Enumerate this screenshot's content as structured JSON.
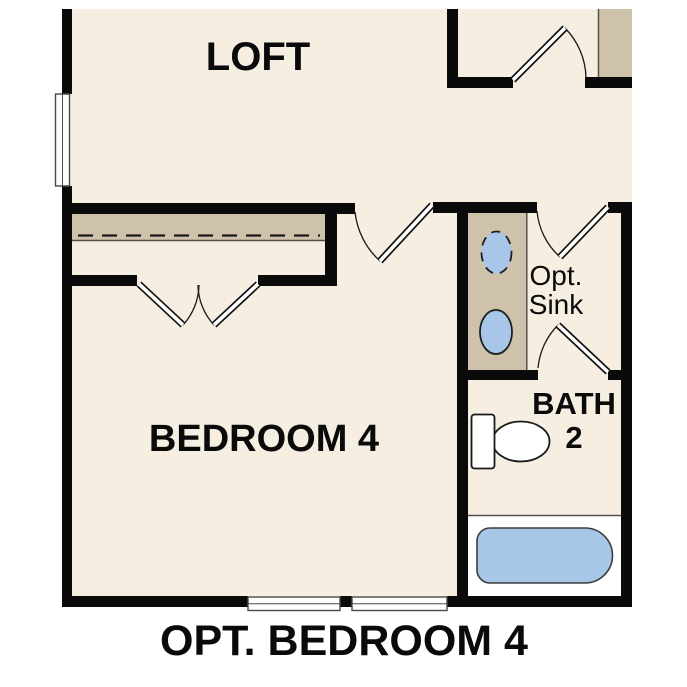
{
  "plan_title": "OPT. BEDROOM 4",
  "rooms": {
    "loft": {
      "label": "LOFT"
    },
    "bedroom4": {
      "label": "BEDROOM 4"
    },
    "bath2": {
      "label_line1": "BATH",
      "label_line2": "2"
    }
  },
  "annotations": {
    "opt_sink": {
      "line1": "Opt.",
      "line2": "Sink"
    }
  },
  "colors": {
    "floor": "#f5eee1",
    "casework": "#cec2ab",
    "fixture-blue": "#a7c6e8",
    "wall": "#0a0a0a",
    "tub-area": "#ffffff"
  }
}
